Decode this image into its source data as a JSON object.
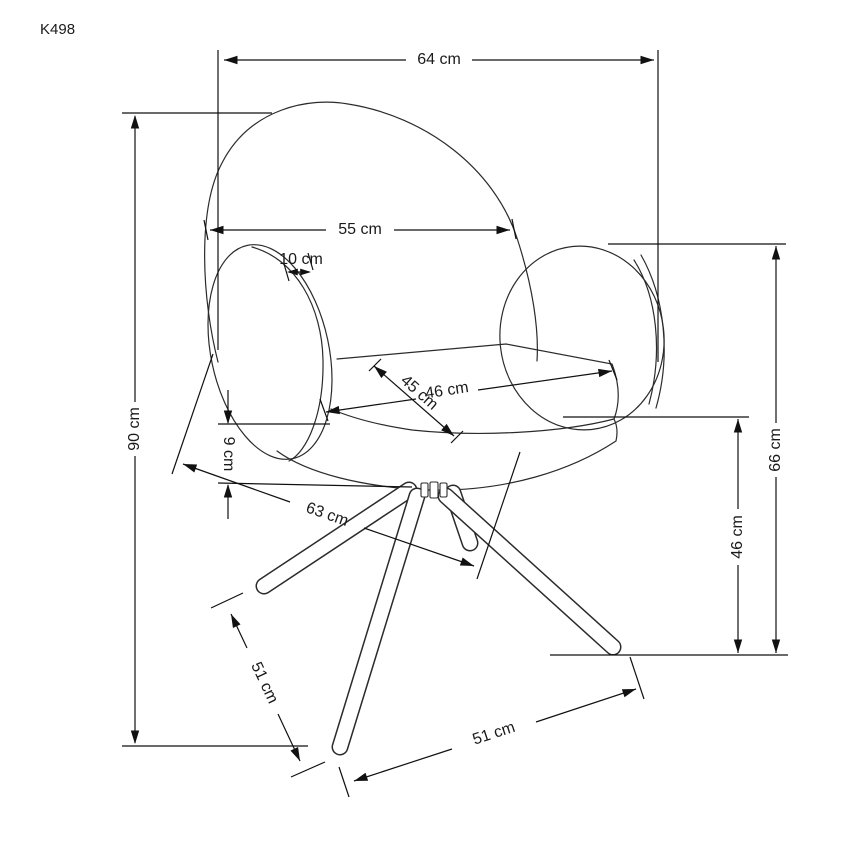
{
  "drawing": {
    "model": "K498"
  },
  "dimensions": {
    "overall_width": "64 cm",
    "backrest_width": "55 cm",
    "armrest_top_thickness": "10 cm",
    "overall_height": "90 cm",
    "seat_width": "46 cm",
    "seat_depth": "45 cm",
    "seat_cushion_thickness": "9 cm",
    "base_depth": "63 cm",
    "armrest_height": "66 cm",
    "seat_height": "46 cm",
    "leg_length": "51 cm",
    "base_width": "51 cm"
  }
}
